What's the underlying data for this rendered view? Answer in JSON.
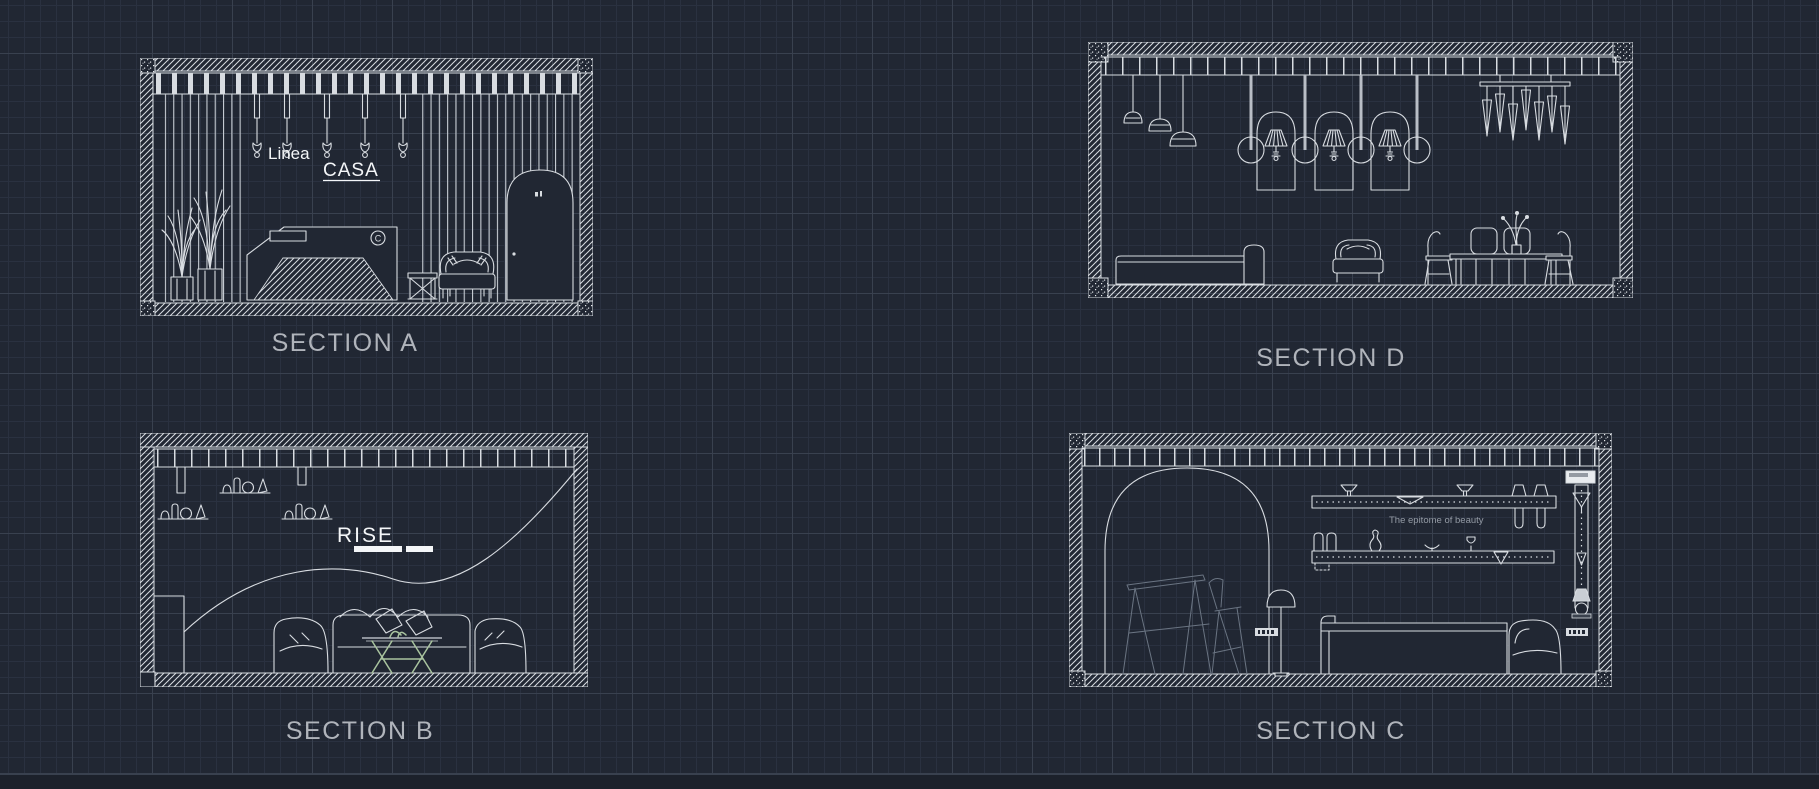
{
  "viewport": {
    "background_color": "#212733",
    "grid_minor_color": "#2a3140",
    "grid_major_color": "#39414f",
    "line_color": "#d8dce1",
    "bright_text_color": "#f4f6f8",
    "caption_color": "#b0b4bb",
    "dim_sketch_color": "#6a7482",
    "muted_text_color": "#949ba5",
    "accent_green": "#a9c49f"
  },
  "sections": {
    "a": {
      "label": "SECTION A",
      "signage": {
        "line1": "Linea",
        "line2": "CASA"
      },
      "desk_logo": "C"
    },
    "b": {
      "label": "SECTION B",
      "signage": "RISE"
    },
    "c": {
      "label": "SECTION C",
      "tagline": "The epitome of beauty"
    },
    "d": {
      "label": "SECTION D"
    }
  }
}
